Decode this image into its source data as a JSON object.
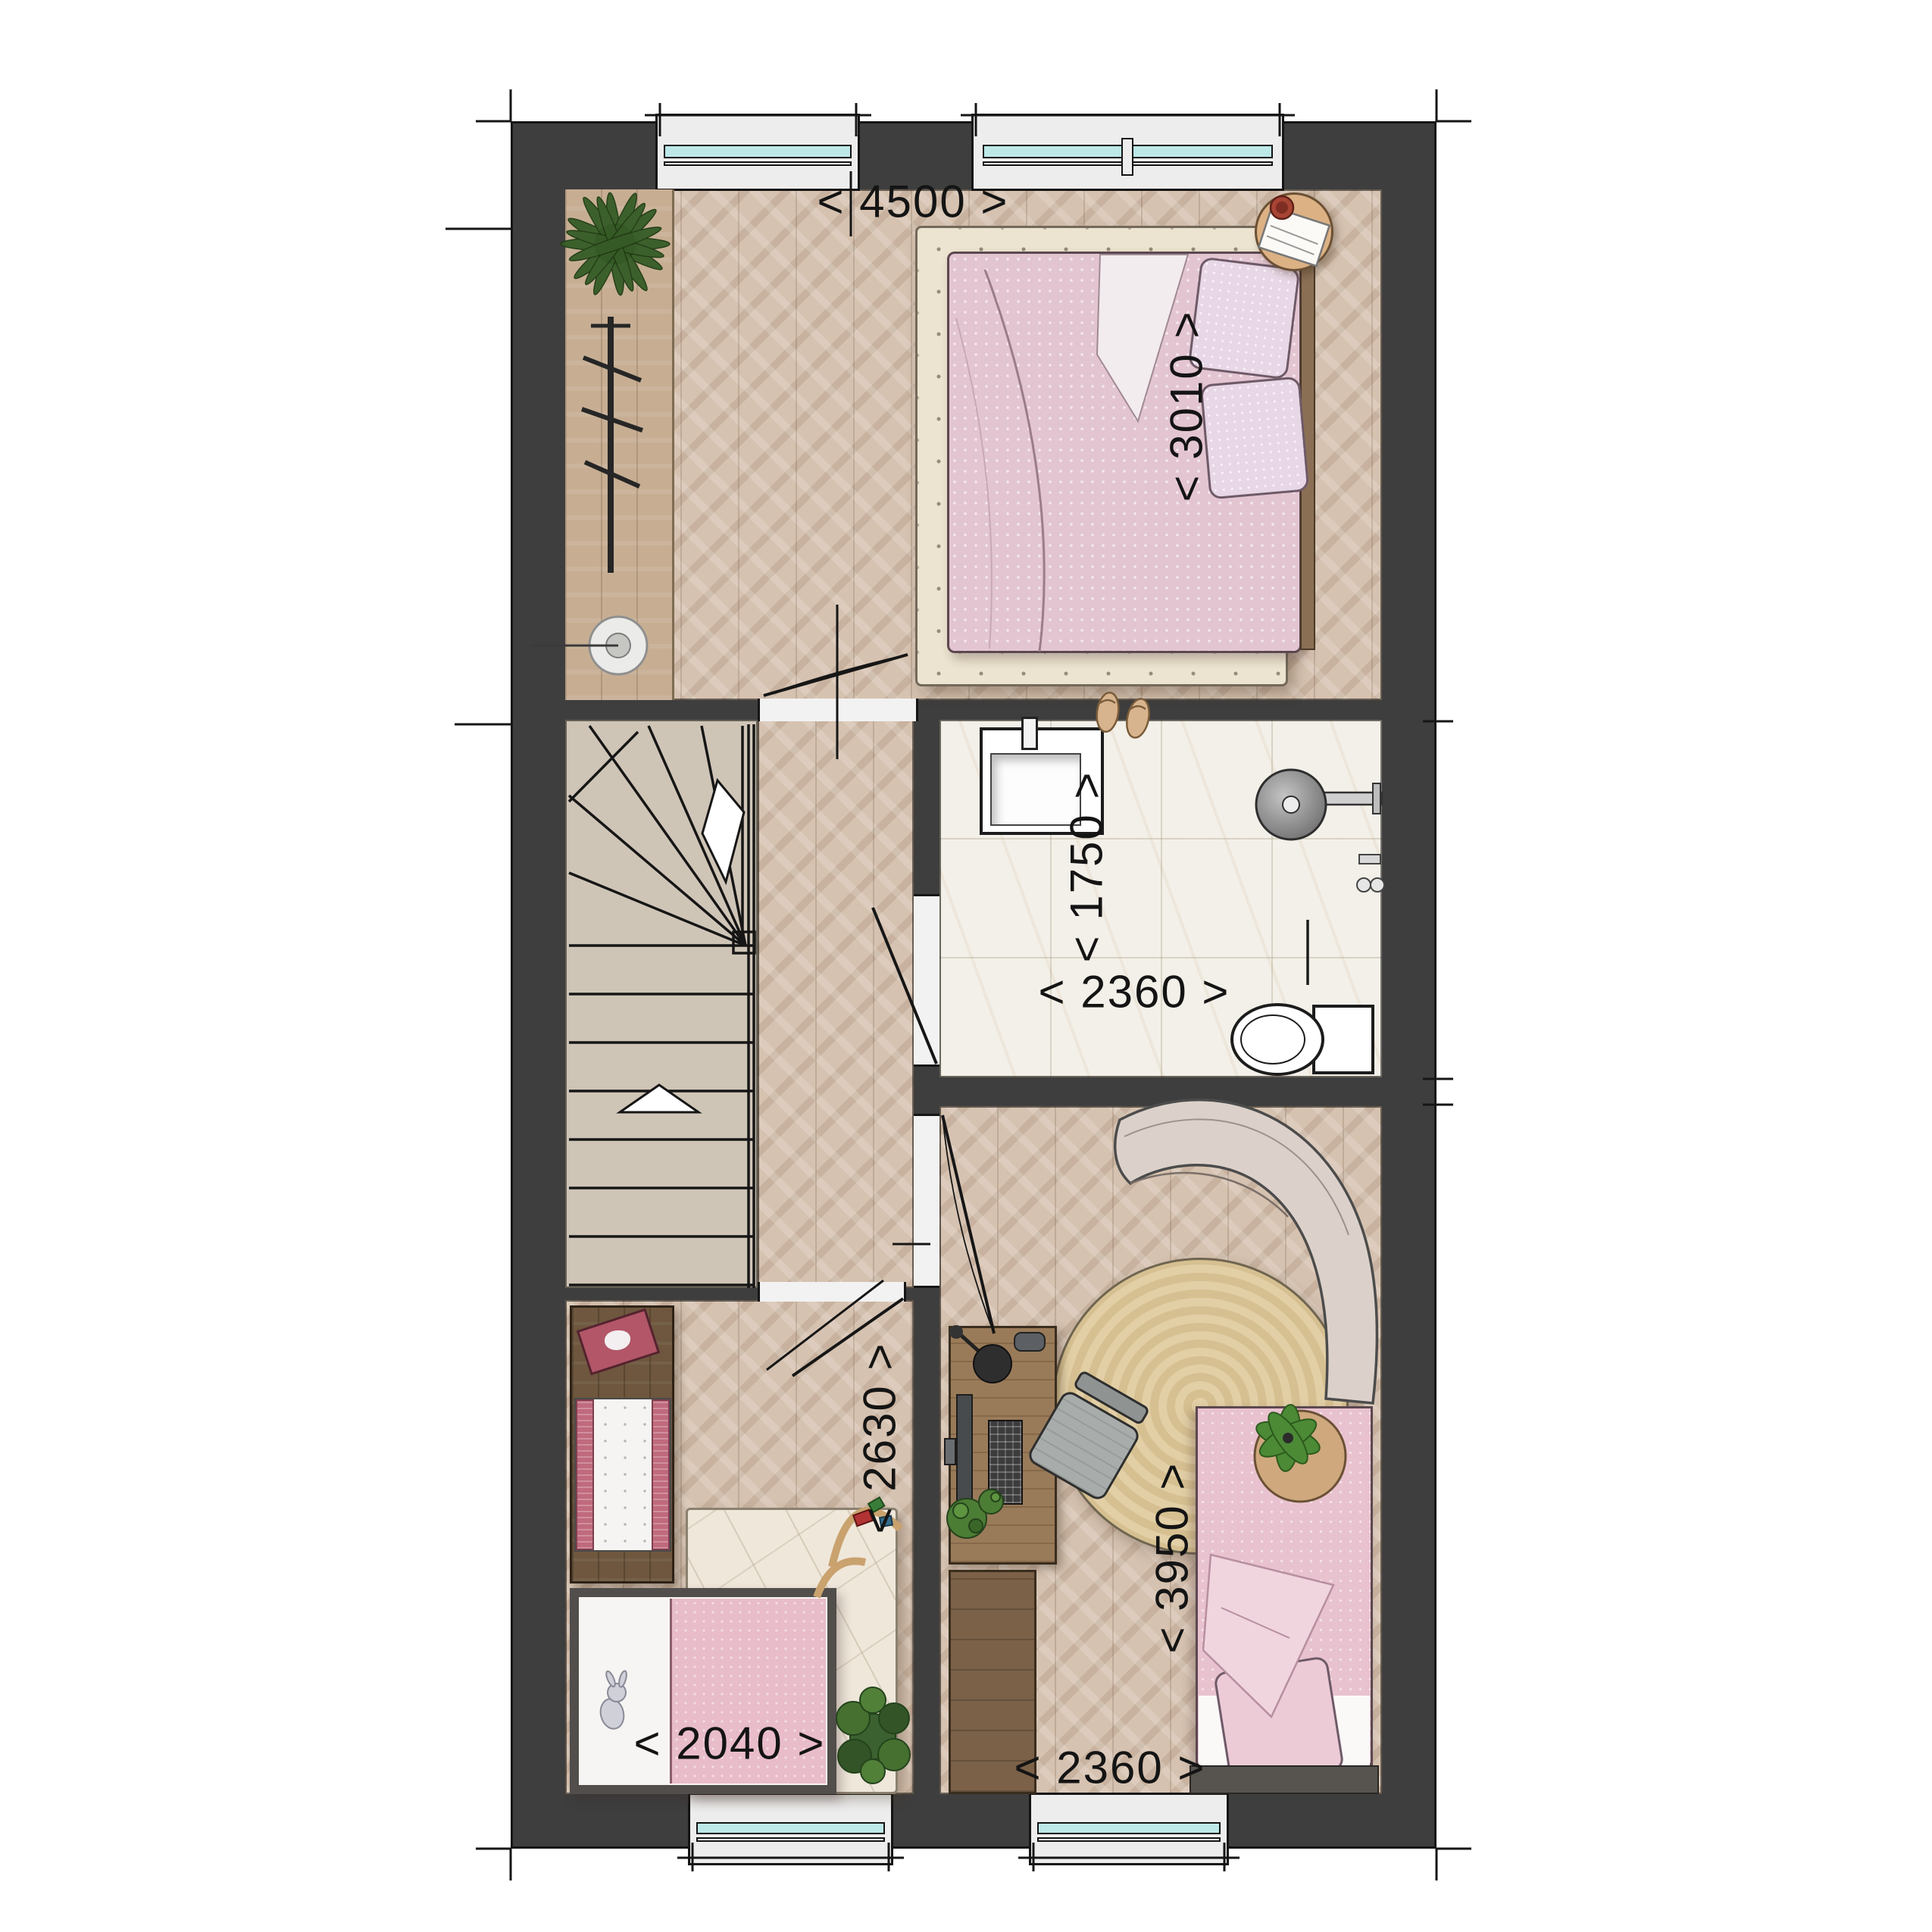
{
  "page": {
    "type": "residential floor plan (first floor), top-down interior render",
    "background": "#ffffff"
  },
  "dimensions": {
    "bedroom_width": "< 4500 >",
    "bedroom_depth": "< 3010 >",
    "bathroom_depth": "< 1750 >",
    "bathroom_width": "< 2360 >",
    "nursery_depth": "< 2630 >",
    "kidsroom_depth": "< 3950 >",
    "baby_bed_width": "< 2040 >",
    "kidsroom_width": "< 2360 >"
  },
  "rooms": [
    {
      "name": "master-bedroom",
      "floor": "chevron oak"
    },
    {
      "name": "bathroom",
      "floor": "marble tile"
    },
    {
      "name": "stairwell",
      "floor": "beige treads"
    },
    {
      "name": "landing-hall",
      "floor": "chevron oak"
    },
    {
      "name": "nursery",
      "floor": "chevron oak"
    },
    {
      "name": "kids-room",
      "floor": "chevron oak"
    }
  ],
  "colors": {
    "wall": "#3e3e3e",
    "wall_outline": "#151515",
    "floor_wood": "#d6c2b0",
    "floor_marble": "#f3f0e9",
    "stairs": "#cfc5b7",
    "window_glass": "#bde8e8",
    "rug_cream": "#ece4d0",
    "rug_jute": "#dcc79b",
    "bed_pink": "#e3c5d1",
    "pillow_lilac": "#e8d7e6",
    "accent_rose": "#b25668",
    "plant_green": "#3c6130",
    "dark_wood": "#6e573e"
  }
}
